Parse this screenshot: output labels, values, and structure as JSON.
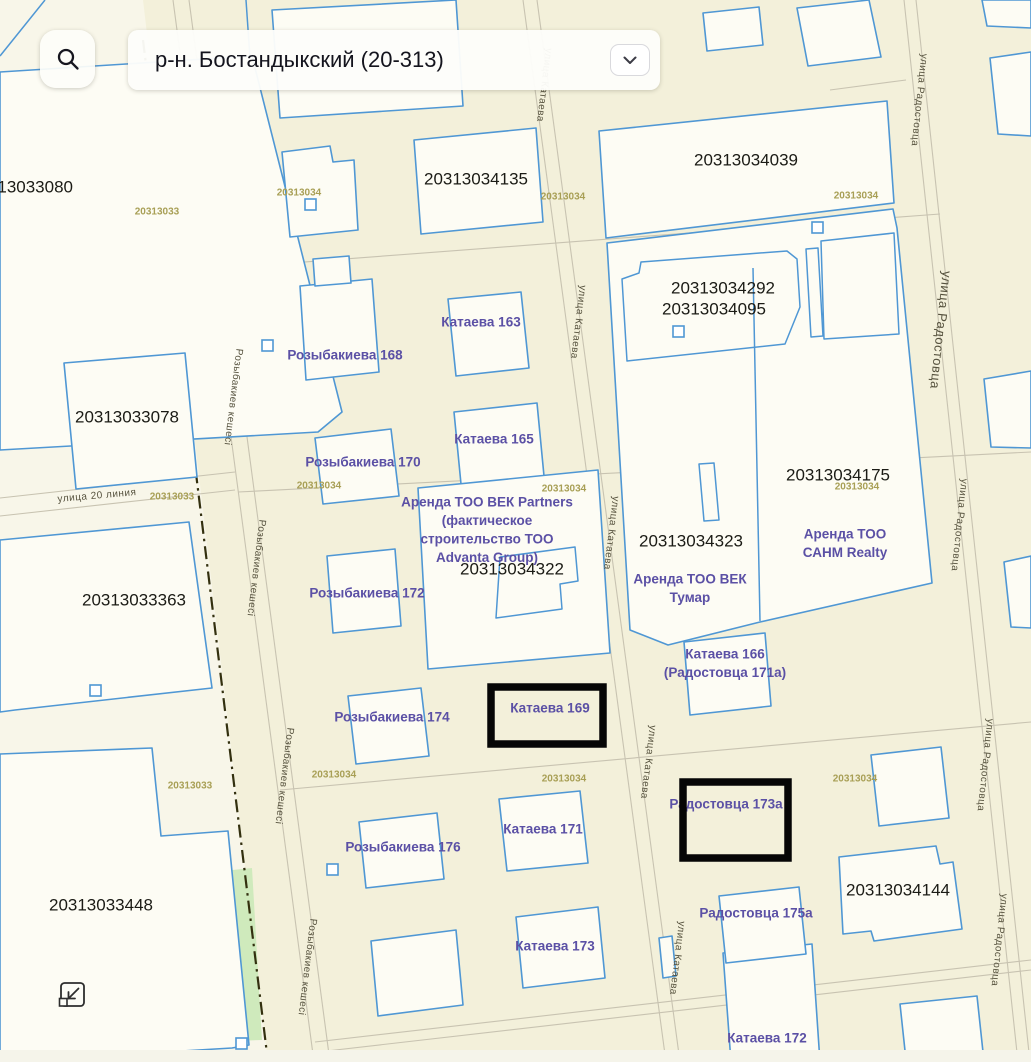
{
  "header": {
    "district_value": "р-н. Бостандыкский (20-313)",
    "search_icon": "magnifier",
    "chevron_icon": "chevron-down"
  },
  "controls": {
    "collapse_icon": "collapse-arrow-bottom-left"
  },
  "map": {
    "colors": {
      "bg": "#f3f0da",
      "bg_left": "#f8f6e9",
      "parcel_fill": "#fdfcf4",
      "parcel_stroke": "#4f97d4",
      "road_line": "#c8c3b1",
      "rail": "#33300f",
      "green": "#cfeabc",
      "cad_text": "#1b1b15",
      "addr_text": "#5b50a5",
      "quarter_text": "#a89f55",
      "street_text": "#55513d",
      "highlight": "#060606",
      "bottom_strip": "#f5f4ea"
    },
    "bg_left_polygon": "0,0 143,0 268,1062 0,1062",
    "greens": [
      "150,338 174,336 177,470 153,472",
      "0,985 155,976 155,878 252,868 262,1040 0,1050"
    ],
    "roads": [
      [
        173,
        0,
        314,
        1062
      ],
      [
        189,
        0,
        330,
        1062
      ],
      [
        523,
        0,
        666,
        1062
      ],
      [
        537,
        0,
        680,
        1062
      ],
      [
        904,
        0,
        1018,
        1062
      ],
      [
        916,
        0,
        1030,
        1062
      ],
      [
        0,
        498,
        235,
        472
      ],
      [
        0,
        516,
        235,
        490
      ],
      [
        212,
        269,
        940,
        214
      ],
      [
        238,
        492,
        1031,
        452
      ],
      [
        280,
        790,
        1031,
        722
      ],
      [
        315,
        1042,
        1031,
        960
      ],
      [
        318,
        1052,
        1031,
        970
      ],
      [
        830,
        90,
        906,
        80
      ]
    ],
    "rail": [
      143,
      40,
      268,
      1062
    ],
    "parcels": [
      "0,72 252,56 342,412 318,432 0,450",
      "272,10 456,0 463,106 280,118",
      "282,152 330,146 333,162 354,160 358,230 290,237",
      "414,140 536,128 543,222 421,234",
      "703,13 759,7 763,45 707,51",
      "797,8 869,0 881,57 808,66",
      "982,0 1031,0 1031,28 987,26",
      "599,131 887,101 894,203 606,238",
      "607,243 893,209 897,228 932,583 760,622 668,645 630,630",
      "684,642 765,633 771,706 690,715",
      "300,286 372,279 379,372 306,380",
      "313,259 349,256 351,283 315,286",
      "448,299 521,292 529,368 456,376",
      "454,412 537,403 544,476 461,484",
      "315,438 391,429 399,496 323,504",
      "418,488 598,470 610,653 428,669",
      "327,556 395,549 401,626 333,633",
      "348,696 421,688 429,756 356,764",
      "359,822 437,813 444,879 366,888",
      "499,799 580,791 588,863 507,871",
      "371,941 456,930 463,1005 378,1016",
      "516,917 598,907 605,978 523,988",
      "659,938 672,936 676,976 663,978",
      "723,953 812,944 820,1062 731,1062",
      "900,1004 977,996 983,1052 906,1060",
      "719,896 799,887 806,954 726,963",
      "871,755 941,747 949,818 879,826",
      "839,857 936,846 940,864 953,862 962,929 874,941 871,931 843,934",
      "64,363 185,353 197,477 76,489",
      "0,540 189,522 212,688 15,710 0,712",
      "0,754 152,748 161,836 228,831 249,1045 232,1048 0,1062",
      "990,58 1031,52 1031,136 998,134",
      "984,379 1031,371 1031,448 991,447",
      "1004,562 1031,556 1031,628 1011,627"
    ],
    "buildings": [
      "622,279 639,273 641,262 787,251 797,259 800,307 785,344 627,361",
      "806,249 818,248 823,336 811,337",
      "821,241 894,233 899,334 824,339",
      "699,464 714,463 719,520 704,521",
      "500,557 575,547 578,581 560,584 562,609 496,618"
    ],
    "blue_lines": [
      "0,56 45,0",
      "250,58 246,0",
      "753,268 760,621"
    ],
    "markers": [
      {
        "x": 267,
        "y": 345
      },
      {
        "x": 95,
        "y": 690
      },
      {
        "x": 678,
        "y": 331
      },
      {
        "x": 817,
        "y": 227
      },
      {
        "x": 310,
        "y": 204
      },
      {
        "x": 332,
        "y": 869
      },
      {
        "x": 241,
        "y": 1043
      }
    ],
    "cadastral_labels": [
      {
        "text": "20313033080",
        "x": 21,
        "y": 187,
        "size": 17
      },
      {
        "text": "20313033078",
        "x": 127,
        "y": 417,
        "size": 17
      },
      {
        "text": "20313033363",
        "x": 134,
        "y": 600,
        "size": 17
      },
      {
        "text": "20313033448",
        "x": 101,
        "y": 905,
        "size": 17
      },
      {
        "text": "20313034135",
        "x": 476,
        "y": 179,
        "size": 17
      },
      {
        "text": "20313034039",
        "x": 746,
        "y": 160,
        "size": 17
      },
      {
        "text": "20313034292",
        "x": 723,
        "y": 288,
        "size": 17
      },
      {
        "text": "20313034095",
        "x": 714,
        "y": 309,
        "size": 17
      },
      {
        "text": "20313034175",
        "x": 838,
        "y": 475,
        "size": 17
      },
      {
        "text": "20313034323",
        "x": 691,
        "y": 541,
        "size": 17
      },
      {
        "text": "20313034322",
        "x": 512,
        "y": 569,
        "size": 17
      },
      {
        "text": "20313034144",
        "x": 898,
        "y": 890,
        "size": 17
      }
    ],
    "address_labels": [
      {
        "lines": [
          "Розыбакиева 168"
        ],
        "x": 345,
        "y": 355
      },
      {
        "lines": [
          "Катаева 163"
        ],
        "x": 481,
        "y": 322
      },
      {
        "lines": [
          "Розыбакиева 170"
        ],
        "x": 363,
        "y": 462
      },
      {
        "lines": [
          "Катаева 165"
        ],
        "x": 494,
        "y": 439
      },
      {
        "lines": [
          "Аренда ТОО ВЕК Partners",
          "(фактическое",
          "строительство ТОО",
          "Advanta Group)"
        ],
        "x": 487,
        "y": 502
      },
      {
        "lines": [
          "Розыбакиева 172"
        ],
        "x": 367,
        "y": 593
      },
      {
        "lines": [
          "Аренда ТОО ВЕК",
          "Тумар"
        ],
        "x": 690,
        "y": 579
      },
      {
        "lines": [
          "Аренда ТОО",
          "САНМ Realty"
        ],
        "x": 845,
        "y": 534
      },
      {
        "lines": [
          "Катаева 166",
          "(Радостовца 171а)"
        ],
        "x": 725,
        "y": 654
      },
      {
        "lines": [
          "Розыбакиева 174"
        ],
        "x": 392,
        "y": 717
      },
      {
        "lines": [
          "Катаева 169"
        ],
        "x": 550,
        "y": 708
      },
      {
        "lines": [
          "Радостовца 173а"
        ],
        "x": 726,
        "y": 804
      },
      {
        "lines": [
          "Розыбакиева 176"
        ],
        "x": 403,
        "y": 847
      },
      {
        "lines": [
          "Катаева 171"
        ],
        "x": 543,
        "y": 829
      },
      {
        "lines": [
          "Радостовца 175а"
        ],
        "x": 756,
        "y": 913
      },
      {
        "lines": [
          "Катаева 173"
        ],
        "x": 555,
        "y": 946
      },
      {
        "lines": [
          "Катаева 172"
        ],
        "x": 767,
        "y": 1038
      }
    ],
    "quarter_labels": [
      {
        "text": "20313033",
        "x": 157,
        "y": 212
      },
      {
        "text": "20313034",
        "x": 299,
        "y": 193
      },
      {
        "text": "20313034",
        "x": 563,
        "y": 197
      },
      {
        "text": "20313034",
        "x": 856,
        "y": 196
      },
      {
        "text": "20313033",
        "x": 172,
        "y": 497
      },
      {
        "text": "20313034",
        "x": 319,
        "y": 486
      },
      {
        "text": "20313034",
        "x": 564,
        "y": 489
      },
      {
        "text": "20313034",
        "x": 857,
        "y": 487
      },
      {
        "text": "20313033",
        "x": 190,
        "y": 786
      },
      {
        "text": "20313034",
        "x": 334,
        "y": 775
      },
      {
        "text": "20313034",
        "x": 564,
        "y": 779
      },
      {
        "text": "20313034",
        "x": 855,
        "y": 779
      }
    ],
    "street_labels": [
      {
        "text": "улица Катаева",
        "x": 544,
        "y": 85,
        "angle": 97,
        "size": 10
      },
      {
        "text": "улица Катаева",
        "x": 578,
        "y": 322,
        "angle": 97,
        "size": 10
      },
      {
        "text": "улица Катаева",
        "x": 611,
        "y": 533,
        "angle": 97,
        "size": 10
      },
      {
        "text": "улица Катаева",
        "x": 648,
        "y": 762,
        "angle": 97,
        "size": 10
      },
      {
        "text": "улица Катаева",
        "x": 677,
        "y": 958,
        "angle": 97,
        "size": 10
      },
      {
        "text": "улица Радостовца",
        "x": 919,
        "y": 100,
        "angle": 96,
        "size": 10
      },
      {
        "text": "улица Радостовца",
        "x": 941,
        "y": 330,
        "angle": 96,
        "size": 13
      },
      {
        "text": "улица Радостовца",
        "x": 959,
        "y": 525,
        "angle": 96,
        "size": 10
      },
      {
        "text": "улица Радостовца",
        "x": 985,
        "y": 765,
        "angle": 96,
        "size": 10
      },
      {
        "text": "улица Радостовца",
        "x": 999,
        "y": 940,
        "angle": 96,
        "size": 10
      },
      {
        "text": "Розыбакиев кешесі",
        "x": 233,
        "y": 397,
        "angle": 97,
        "size": 10
      },
      {
        "text": "Розыбакиев кешесі",
        "x": 256,
        "y": 568,
        "angle": 97,
        "size": 10
      },
      {
        "text": "Розыбакиев кешесі",
        "x": 284,
        "y": 776,
        "angle": 97,
        "size": 10
      },
      {
        "text": "Розыбакиев кешесі",
        "x": 307,
        "y": 967,
        "angle": 97,
        "size": 10
      },
      {
        "text": "улица 20 линия",
        "x": 97,
        "y": 496,
        "angle": -5,
        "size": 10
      }
    ],
    "highlight_boxes": [
      {
        "x": 491,
        "y": 687,
        "w": 112,
        "h": 57
      },
      {
        "x": 683,
        "y": 782,
        "w": 105,
        "h": 76
      }
    ]
  }
}
